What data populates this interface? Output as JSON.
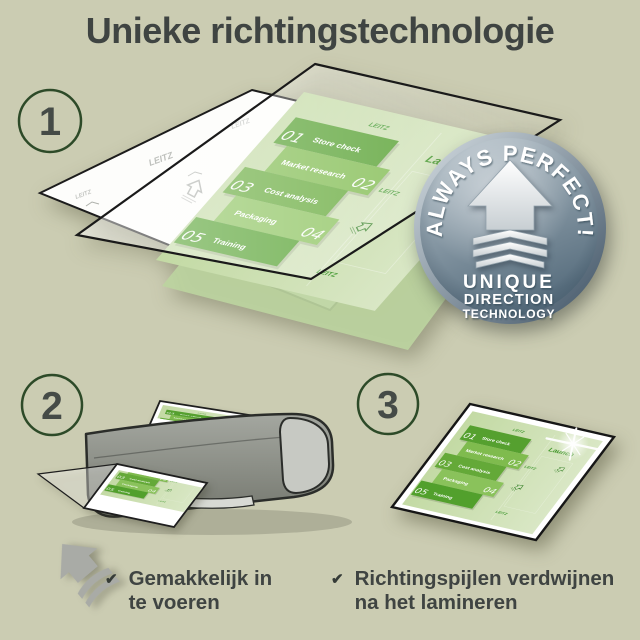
{
  "title": "Unieke richtingstechnologie",
  "step_numbers": [
    "1",
    "2",
    "3"
  ],
  "badge": {
    "arc_text": "ALWAYS PERFECT!",
    "line1": "UNIQUE",
    "line2": "DIRECTION",
    "line3": "TECHNOLOGY"
  },
  "plan": {
    "brand_watermark": "LEITZ",
    "launch": "Launch",
    "items": [
      {
        "num": "01",
        "label": "Store check"
      },
      {
        "num": "02",
        "label": "Market research"
      },
      {
        "num": "03",
        "label": "Cost analysis"
      },
      {
        "num": "04",
        "label": "Packaging"
      },
      {
        "num": "05",
        "label": "Training"
      }
    ]
  },
  "checklist": [
    {
      "icon": "✔",
      "line1": "Gemakkelijk in",
      "line2": "te voeren"
    },
    {
      "icon": "✔",
      "line1": "Richtingspijlen verdwijnen",
      "line2": "na het lamineren"
    }
  ],
  "colors": {
    "background": "#cbccb2",
    "text": "#3f4442",
    "circle_outline": "#2d4a28",
    "plan_green_dark": "#55a02f",
    "plan_green_light": "#8ac25b",
    "plan_page": "#cddfb2",
    "badge_face": "#7e93a3",
    "machine_gray": "#8c9089",
    "arrow_gray": "#a9aba6"
  }
}
